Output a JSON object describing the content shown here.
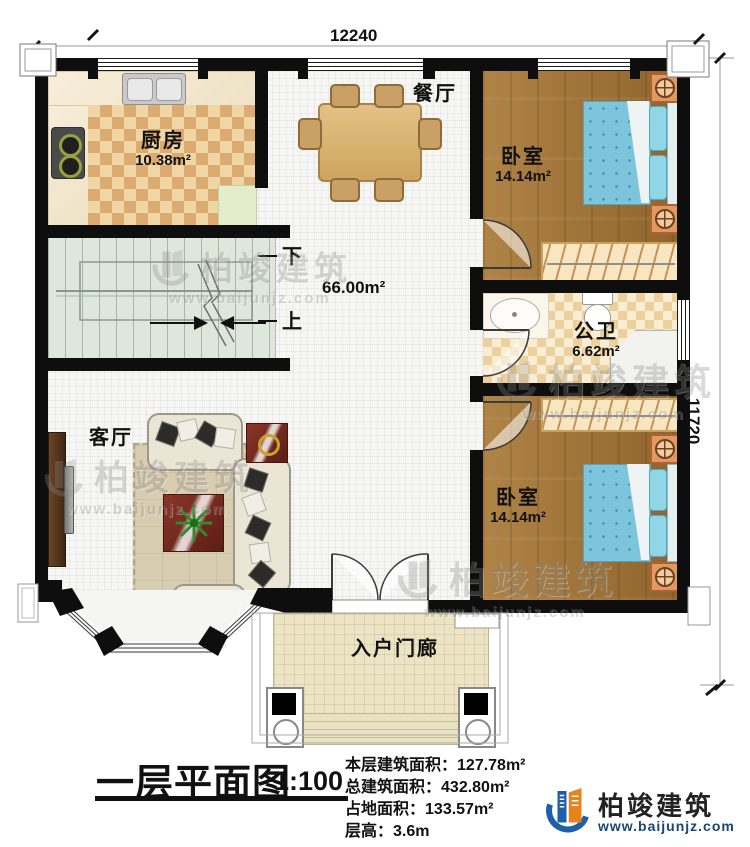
{
  "plan": {
    "dim_top": "12240",
    "dim_right": "11720",
    "stair_down": "下",
    "stair_up": "上",
    "stair_area": "66.00m²",
    "rooms": {
      "kitchen": {
        "name": "厨房",
        "area": "10.38m²"
      },
      "dining": {
        "name": "餐厅"
      },
      "bedroom1": {
        "name": "卧室",
        "area": "14.14m²"
      },
      "bathroom": {
        "name": "公卫",
        "area": "6.62m²"
      },
      "living": {
        "name": "客厅"
      },
      "bedroom2": {
        "name": "卧室",
        "area": "14.14m²"
      },
      "porch": {
        "name": "入户门廊"
      }
    }
  },
  "footer": {
    "title": "一层平面图",
    "scale": "1:100",
    "stats": [
      {
        "label": "本层建筑面积：",
        "value": "127.78m²"
      },
      {
        "label": "总建筑面积：",
        "value": "432.80m²"
      },
      {
        "label": "占地面积：",
        "value": "133.57m²"
      },
      {
        "label": "层高：",
        "value": "3.6m"
      }
    ],
    "logo_name": "柏竣建筑",
    "logo_url": "www.baijunjz.com"
  },
  "watermark": {
    "name": "柏竣建筑",
    "url": "www.baijunjz.com"
  },
  "colors": {
    "wall": "#0e0e0e",
    "wood_floor": "#a5763c",
    "bed_blue": "#7cc5dc",
    "checker_tan": "#dcab72",
    "logo_blue": "#1d5fa8",
    "logo_orange": "#e8821e"
  }
}
